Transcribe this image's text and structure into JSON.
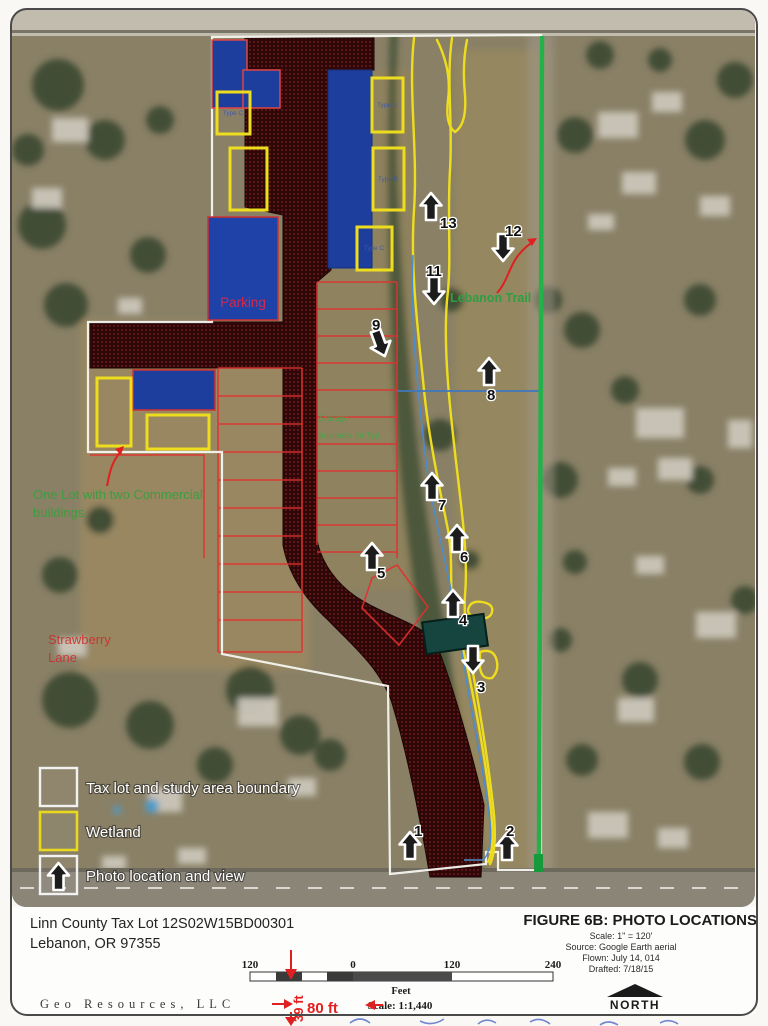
{
  "map": {
    "labels": {
      "parking": "Parking",
      "strawberry_line1": "Strawberry",
      "strawberry_line2": "Lane",
      "one_lot_line1": "One Lot with two Commercial",
      "one_lot_line2": "buildings.",
      "storage_line1": "Storage",
      "storage_line2": "business lot Typ.",
      "lebanon_trail": "Lebanon Trail"
    },
    "wetland_labels": [
      {
        "label": "Type C"
      },
      {
        "label": "Type A"
      },
      {
        "label": "Type B"
      },
      {
        "label": "Type C"
      }
    ],
    "photo_points": [
      {
        "label": "1"
      },
      {
        "label": "2"
      },
      {
        "label": "3"
      },
      {
        "label": "4"
      },
      {
        "label": "5"
      },
      {
        "label": "6"
      },
      {
        "label": "7"
      },
      {
        "label": "8"
      },
      {
        "label": "9"
      },
      {
        "label": "11"
      },
      {
        "label": "12"
      },
      {
        "label": "13"
      }
    ]
  },
  "legend": {
    "items": [
      {
        "label": "Tax lot and study area boundary"
      },
      {
        "label": "Wetland"
      },
      {
        "label": "Photo location and view"
      }
    ]
  },
  "footer": {
    "address_line1": "Linn County Tax Lot 12S02W15BD00301",
    "address_line2": "Lebanon, OR 97355",
    "company": "Geo Resources, LLC",
    "figure_title": "FIGURE 6B: PHOTO LOCATIONS",
    "scale_note": "Scale: 1\" = 120'",
    "source": "Source: Google Earth aerial",
    "flown": "Flown: July 14, 014",
    "drafted": "Drafted: 7/18/15",
    "north_label": "NORTH"
  },
  "scale_bar": {
    "ticks": [
      {
        "v": "120"
      },
      {
        "v": "0"
      },
      {
        "v": "120"
      },
      {
        "v": "240"
      }
    ],
    "unit": "Feet",
    "ratio": "Scale: 1:1,440"
  },
  "annotations": {
    "len39": "39 ft",
    "len80": "80 ft"
  },
  "colors": {
    "boundary_white": "#f5f5f0",
    "wetland_yellow": "#eedd1e",
    "road_maroon": "#2e0808",
    "building_blue": "#1d3e9c",
    "green_line": "#21b24a",
    "annotation_red": "#e02020"
  }
}
